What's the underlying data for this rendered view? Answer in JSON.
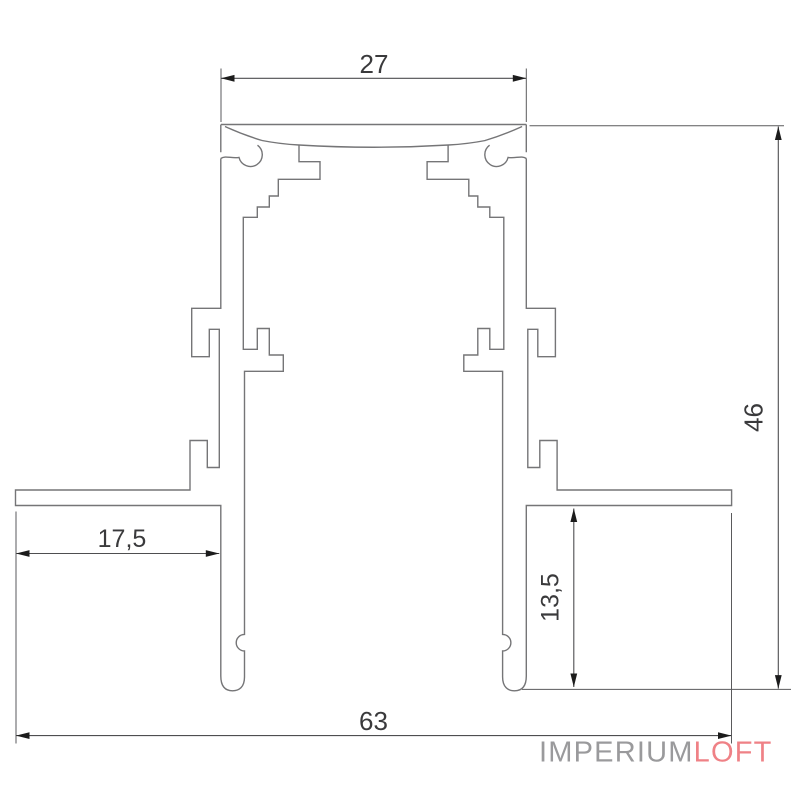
{
  "drawing": {
    "type": "profile-cross-section",
    "dimensions": {
      "top_width": "27",
      "overall_height": "46",
      "flange_width": "17,5",
      "leg_height": "13,5",
      "overall_width": "63"
    }
  },
  "logo": {
    "part1": "IMPERIUM",
    "part2": "LOFT",
    "part1_color": "#9a9a9c",
    "part2_color": "#ef8186"
  }
}
